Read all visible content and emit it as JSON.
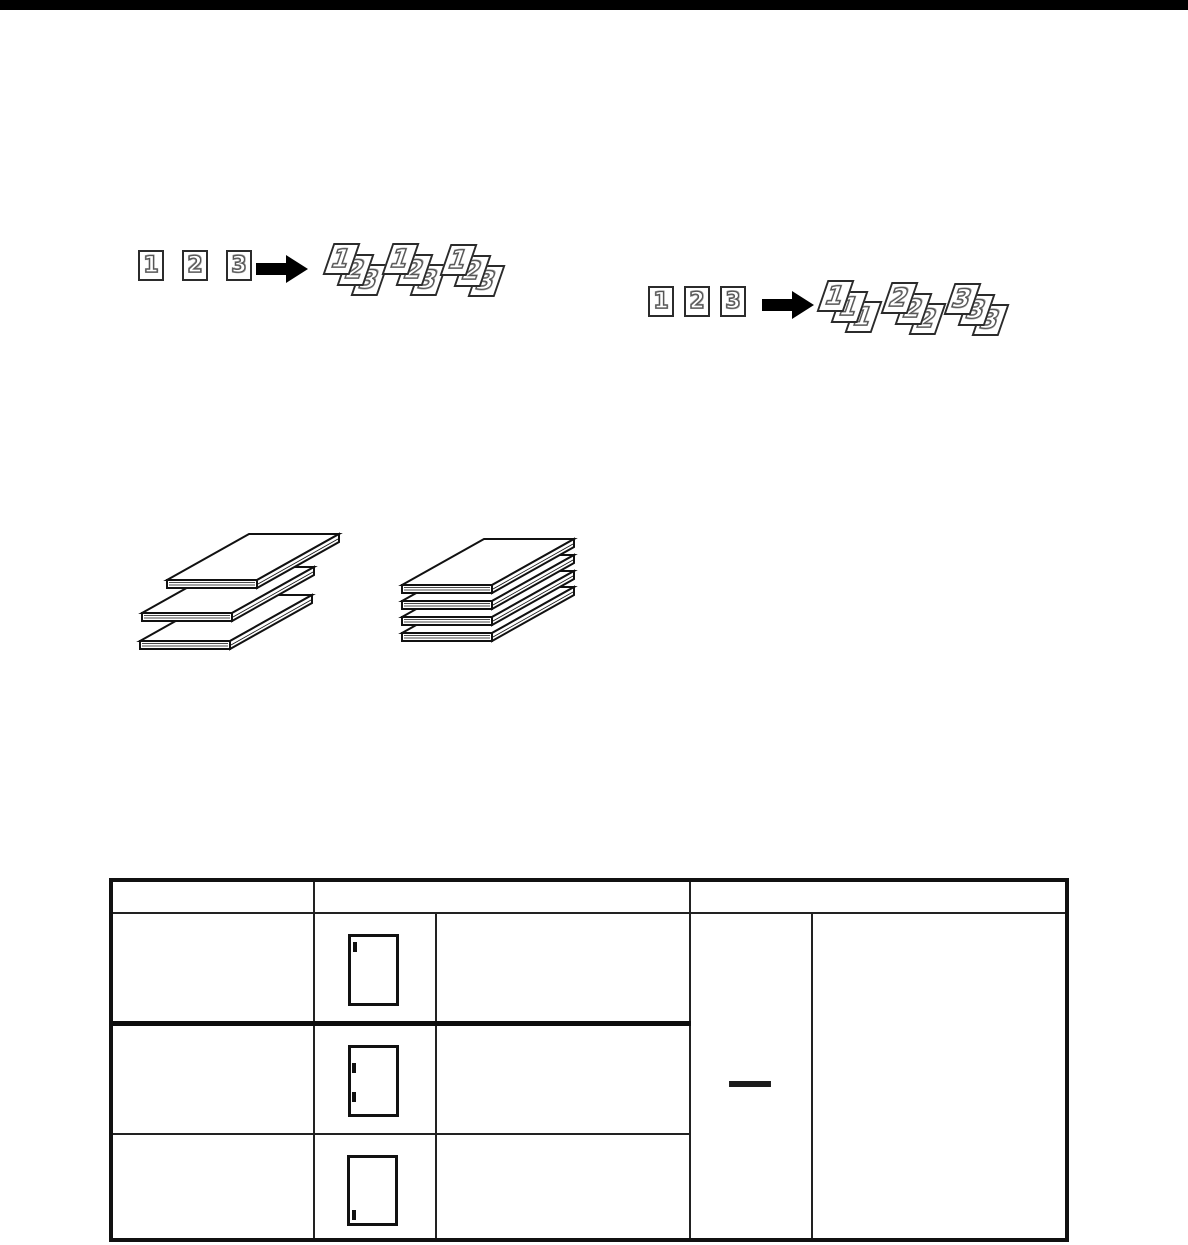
{
  "colors": {
    "ink": "#111111",
    "paper": "#ffffff",
    "top_rule": "#000000"
  },
  "sort_diagram": {
    "inputs": [
      "1",
      "2",
      "3"
    ],
    "sets": [
      {
        "pages": [
          "1",
          "2",
          "3"
        ]
      },
      {
        "pages": [
          "1",
          "2",
          "3"
        ]
      },
      {
        "pages": [
          "1",
          "2",
          "3"
        ]
      }
    ]
  },
  "stack_diagram": {
    "inputs": [
      "1",
      "2",
      "3"
    ],
    "sets": [
      {
        "pages": [
          "1",
          "1",
          "1"
        ]
      },
      {
        "pages": [
          "2",
          "2",
          "2"
        ]
      },
      {
        "pages": [
          "3",
          "3",
          "3"
        ]
      }
    ]
  },
  "paper_stacks": {
    "offset_stack_sheets": 3,
    "aligned_stack_sheets": 4
  },
  "staple_table": {
    "rows": [
      {
        "icon": "page-staple-top-left"
      },
      {
        "icon": "page-staple-left-double"
      },
      {
        "icon": "page-staple-bottom-left"
      }
    ],
    "empty_cell_dash": "—"
  }
}
